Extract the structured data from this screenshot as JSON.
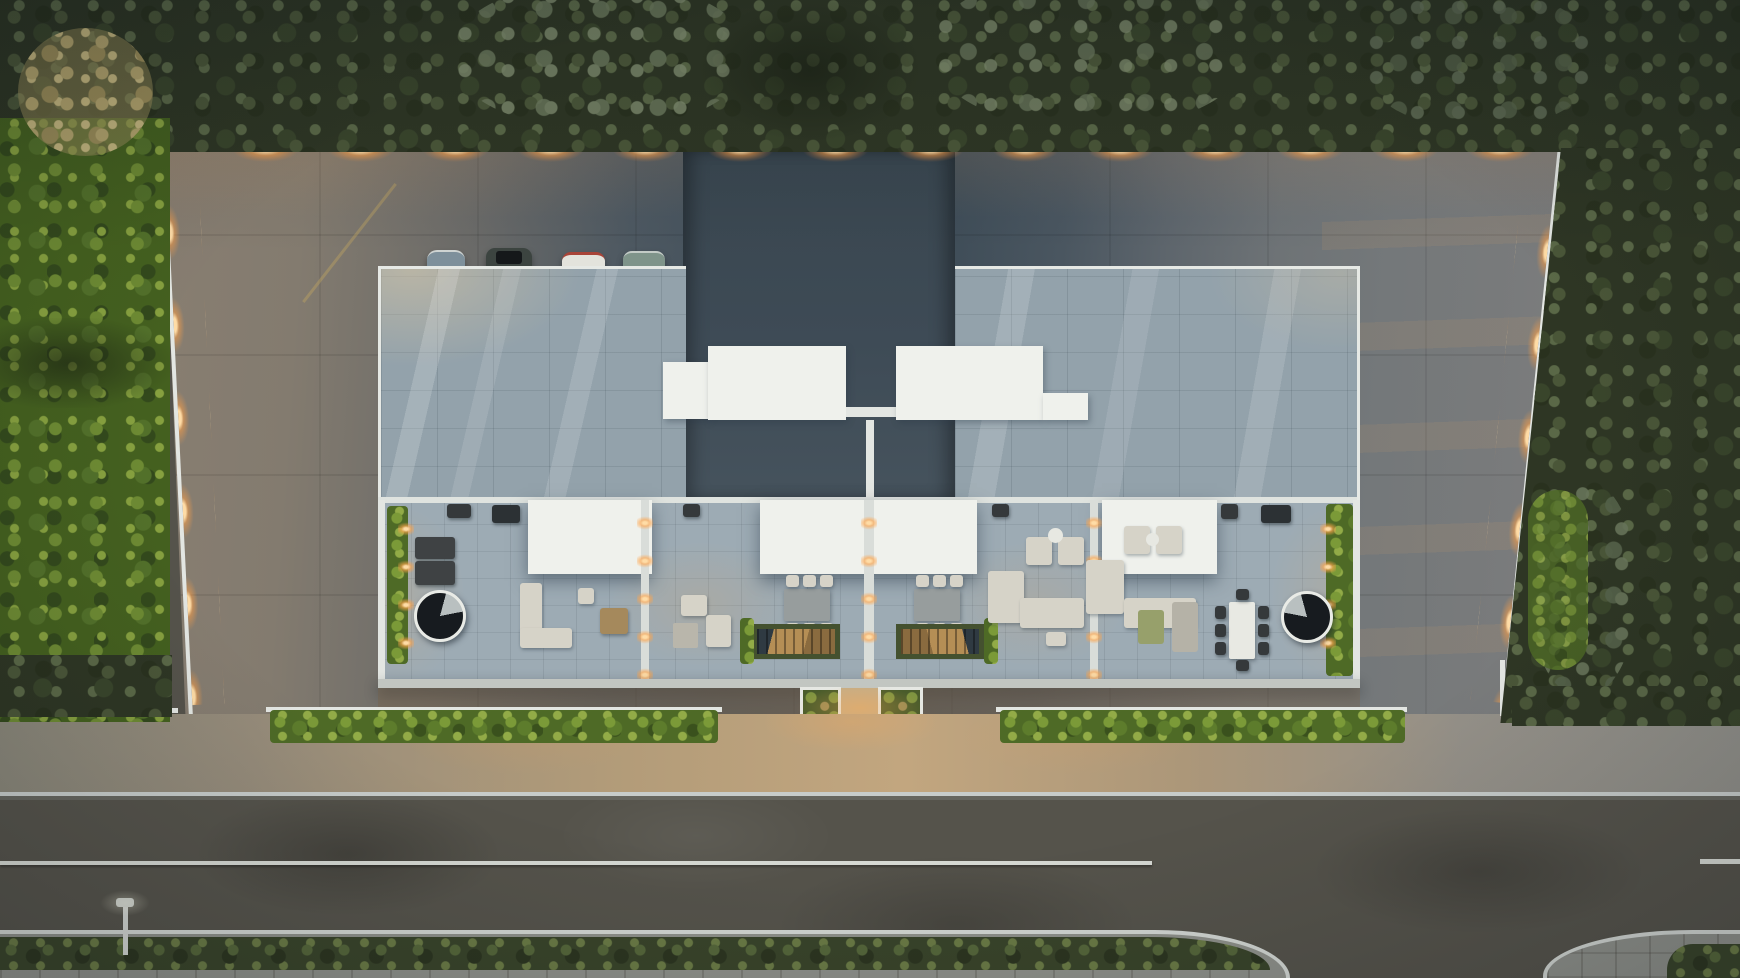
{
  "meta": {
    "title": "Aerial dusk render: top-down view of a modern flat-roof residence with four rooftop terraces, walled courtyard, street and landscaping",
    "width_px": 1740,
    "height_px": 978,
    "time_of_day": "dusk"
  },
  "palette": {
    "warm": "#ffb45e",
    "warmcore": "#ffdca6",
    "wallwhite": "#e3e6e2",
    "canopy": "#eff1ec",
    "rooftile": "#93a2ab",
    "terrace": "#9dabb4",
    "slate": "#3f4c58",
    "asphalt": "#55534b",
    "hedge": "#5a7a2e",
    "olive": "#2e3624",
    "paver": "#b39c79"
  },
  "scene": {
    "vegetation": {
      "label": "Dense olive-green tree canopy bordering the plot on top, left and right, with one tan-yellow tree at top-left",
      "tree_bands": 4,
      "front_hedges": 2
    },
    "plot": {
      "label": "Walled concrete courtyard with warm wall-mounted lights, parking apron at top and driveway at right",
      "boundary_wall_color": "#e3e6e2",
      "wall_light_count_top": 14,
      "parked_cars": 4,
      "car_colors": [
        "steel-blue",
        "black",
        "white-red",
        "sage-gray"
      ]
    },
    "building": {
      "label": "Modern flat-roof duplex residence, two tiled roof planes flanking a recessed dark core with white rooftop volumes",
      "roof_planes": 2,
      "white_roof_volumes": 3,
      "rooftop_terraces": 4,
      "white_pergola_canopies": 3,
      "spiral_staircases": 2,
      "dining_sets": 3,
      "lounge_sets": 4,
      "bbq_grills": 4,
      "planter_skylights": 2
    },
    "street": {
      "label": "Two-lane asphalt road with paver sidewalk, green median strip, curved side-street junction at bottom right and one street lamp",
      "lane_line_color": "#d6d9d3",
      "lanes": 2,
      "street_lamps": 1,
      "entrance_planters": 2
    }
  }
}
